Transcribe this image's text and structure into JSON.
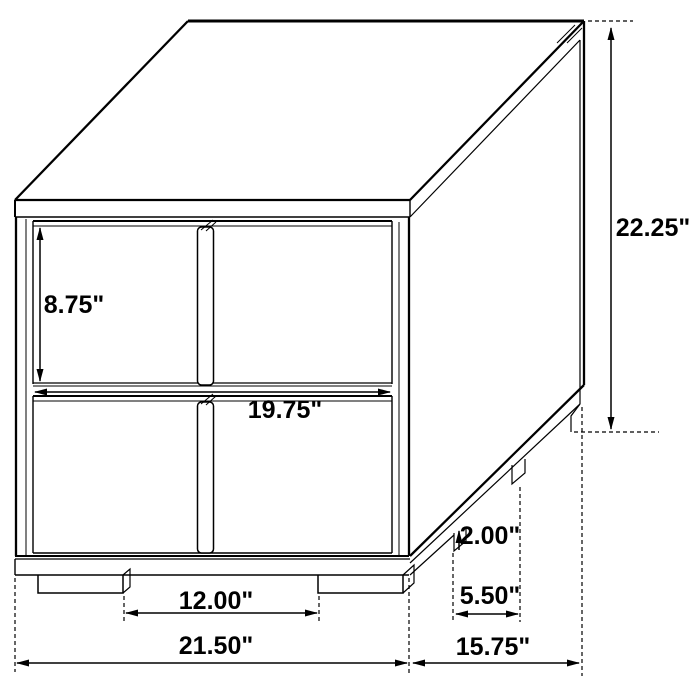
{
  "drawing": {
    "product": "two-drawer-nightstand-dimension-diagram",
    "dimensions": {
      "overall_height": "22.25\"",
      "overall_width": "21.50\"",
      "overall_depth": "15.75\"",
      "drawer_front_height": "8.75\"",
      "drawer_front_width": "19.75\"",
      "leg_height": "2.00\"",
      "front_leg_spacing": "12.00\"",
      "side_leg_spacing": "5.50\""
    }
  }
}
